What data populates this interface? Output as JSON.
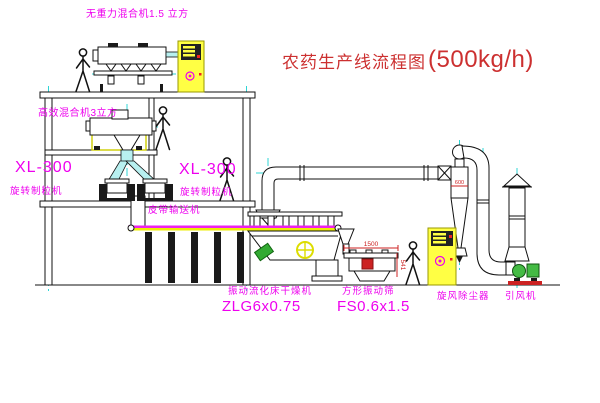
{
  "diagram": {
    "title": {
      "name_zh": "农药生产线流程图",
      "capacity": "(500kg/h)"
    },
    "labels": {
      "gravity_free_mixer": "无重力混合机1.5 立方",
      "high_efficiency_mixer": "高效混合机3立方",
      "granulator_left_model": "XL-300",
      "granulator_left_name": "旋转制粒机",
      "granulator_mid_model": "XL-300",
      "granulator_mid_name": "旋转制粒机",
      "belt_conveyor": "皮带输送机",
      "dryer_name": "振动流化床干燥机",
      "dryer_model": "ZLG6x0.75",
      "screen_name": "方形振动筛",
      "screen_model": "FS0.6x1.5",
      "cyclone": "旋风除尘器",
      "fan": "引风机"
    },
    "dimensions": {
      "screen_length": "1500",
      "screen_height": "541",
      "cyclone_size": "600"
    },
    "colors": {
      "label_magenta": "#ee00ee",
      "title_red": "#cc3030",
      "centerline_cyan": "#2fd5d5",
      "cabinet_yellow": "#ffff44",
      "motor_green": "#33aa33",
      "base_red": "#cc2222",
      "belt_yellow": "#eeee00"
    }
  }
}
